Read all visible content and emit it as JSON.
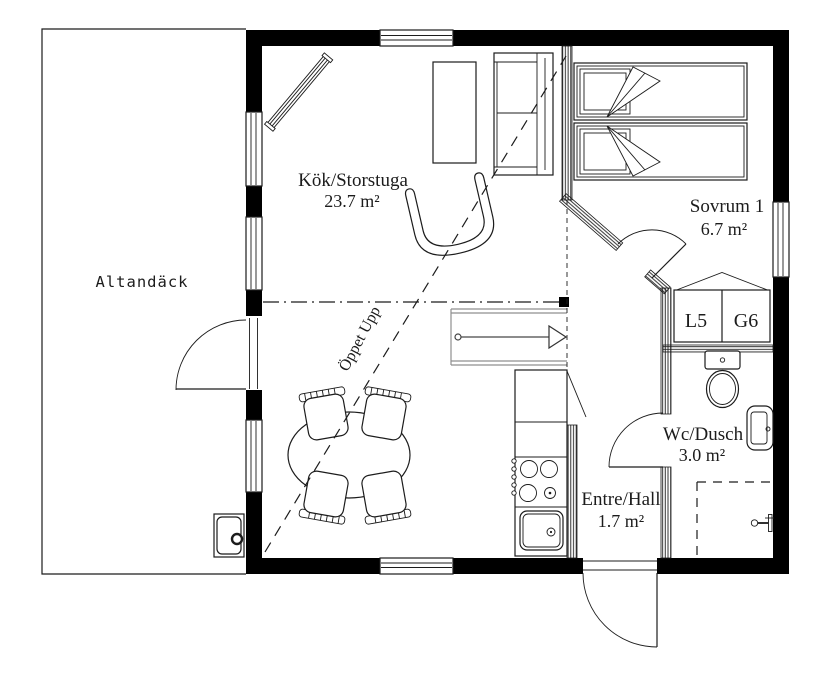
{
  "plan": {
    "colors": {
      "background": "#ffffff",
      "ink": "#1c1c1c",
      "wall": "#000000",
      "stair": "#8f8f8f"
    },
    "rooms": {
      "deck": {
        "name": "Altandäck"
      },
      "kitchen_living": {
        "name": "Kök/Storstuga",
        "area": "23.7 m²"
      },
      "bedroom": {
        "name": "Sovrum 1",
        "area": "6.7 m²"
      },
      "wc": {
        "name": "Wc/Dusch",
        "area": "3.0 m²"
      },
      "hall": {
        "name": "Entre/Hall",
        "area": "1.7 m²"
      }
    },
    "wardrobe": {
      "left": "L5",
      "right": "G6"
    },
    "annotations": {
      "open_above": "Öppet Upp"
    }
  }
}
